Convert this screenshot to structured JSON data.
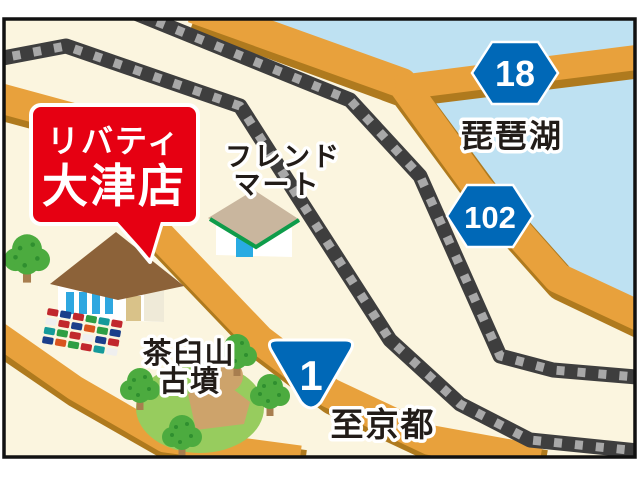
{
  "map": {
    "callout": {
      "line1": "リバティ",
      "line2": "大津店"
    },
    "labels": {
      "lake": "琵琶湖",
      "friend_mart_1": "フレンド",
      "friend_mart_2": "マート",
      "kofun_1": "茶臼山",
      "kofun_2": "古墳",
      "to_kyoto": "至京都"
    },
    "badges": {
      "route_18": "18",
      "route_102": "102",
      "route_1": "1"
    },
    "parking": {
      "car_colors": [
        "#C1272D",
        "#1B3F8B",
        "#C1272D",
        "#2E9E44",
        "#159A9A",
        "#C1272D",
        "#EFEFEF",
        "#C1272D",
        "#1B3F8B",
        "#D9541E",
        "#2E9E44",
        "#1B3F8B",
        "#159A9A",
        "#2E9E44",
        "#C1272D",
        "#EFEFEF",
        "#1B3F8B",
        "#C1272D",
        "#1B3F8B",
        "#D9541E",
        "#2E9E44",
        "#C1272D",
        "#159A9A",
        "#EFEFEF"
      ]
    },
    "colors": {
      "land": "#FBF5DF",
      "lake": "#BEE1F2",
      "road": "#E8A13C",
      "road_shadow": "#AF7A1E",
      "railway_dark": "#3E3E3E",
      "railway_tie": "#A8A8A8",
      "callout_red": "#E60012",
      "badge_blue": "#0068B7",
      "park_green": "#97CC5E",
      "kofun_tan": "#CDA36B",
      "tree_green": "#4CAB3F",
      "store_roof": "#8C6239",
      "window_blue": "#2EA7E0",
      "fm_roof": "#C9B69E",
      "fm_green": "#0E9C4A"
    }
  }
}
